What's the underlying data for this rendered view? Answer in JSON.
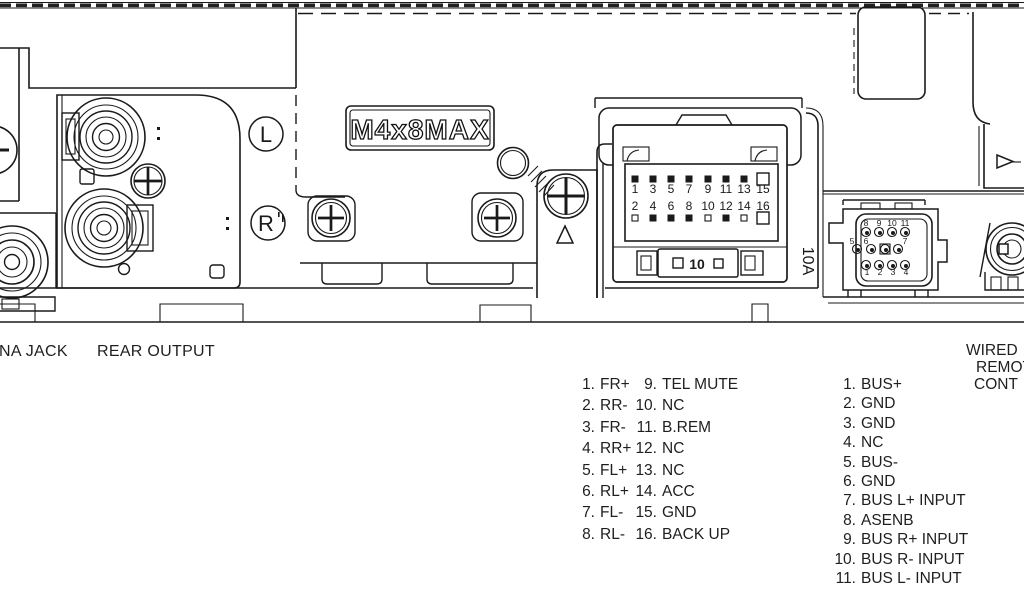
{
  "colors": {
    "background": "#ffffff",
    "line": "#1a1a1a"
  },
  "diagram": {
    "plate_label": "M4x8MAX",
    "left_output_jack_label": "L",
    "right_output_jack_label": "R",
    "fuse_window_label": "10",
    "fuse_rating_label": "10A"
  },
  "connector_16pin": {
    "odd_row_numbers": [
      "1",
      "3",
      "5",
      "7",
      "9",
      "11",
      "13",
      "15"
    ],
    "even_row_numbers": [
      "2",
      "4",
      "6",
      "8",
      "10",
      "12",
      "14",
      "16"
    ]
  },
  "remote_connector": {
    "top_row_numbers": [
      "8",
      "9",
      "10",
      "11"
    ],
    "middle_row_numbers": [
      "5",
      "6",
      "7"
    ],
    "bottom_row_numbers": [
      "1",
      "2",
      "3",
      "4"
    ]
  },
  "captions": {
    "antenna_jack": "NA JACK",
    "rear_output": "REAR OUTPUT",
    "wired_remote_lines": [
      "WIRED",
      "REMOT",
      "CONT"
    ]
  },
  "pinout_main": {
    "left_column": [
      {
        "num": "1.",
        "label": "FR+"
      },
      {
        "num": "2.",
        "label": "RR-"
      },
      {
        "num": "3.",
        "label": "FR-"
      },
      {
        "num": "4.",
        "label": "RR+"
      },
      {
        "num": "5.",
        "label": "FL+"
      },
      {
        "num": "6.",
        "label": "RL+"
      },
      {
        "num": "7.",
        "label": "FL-"
      },
      {
        "num": "8.",
        "label": "RL-"
      }
    ],
    "right_column": [
      {
        "num": "9.",
        "label": "TEL MUTE"
      },
      {
        "num": "10.",
        "label": "NC"
      },
      {
        "num": "11.",
        "label": "B.REM"
      },
      {
        "num": "12.",
        "label": "NC"
      },
      {
        "num": "13.",
        "label": "NC"
      },
      {
        "num": "14.",
        "label": "ACC"
      },
      {
        "num": "15.",
        "label": "GND"
      },
      {
        "num": "16.",
        "label": "BACK UP"
      }
    ]
  },
  "pinout_bus": [
    {
      "num": "1.",
      "label": "BUS+"
    },
    {
      "num": "2.",
      "label": "GND"
    },
    {
      "num": "3.",
      "label": "GND"
    },
    {
      "num": "4.",
      "label": "NC"
    },
    {
      "num": "5.",
      "label": "BUS-"
    },
    {
      "num": "6.",
      "label": "GND"
    },
    {
      "num": "7.",
      "label": "BUS L+ INPUT"
    },
    {
      "num": "8.",
      "label": "ASENB"
    },
    {
      "num": "9.",
      "label": "BUS R+ INPUT"
    },
    {
      "num": "10.",
      "label": "BUS R- INPUT"
    },
    {
      "num": "11.",
      "label": "BUS L- INPUT"
    }
  ]
}
